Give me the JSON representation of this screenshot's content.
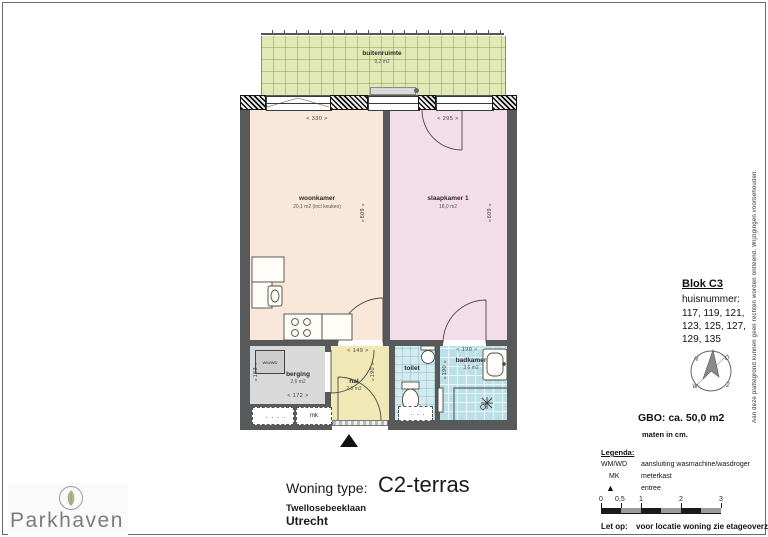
{
  "page": {
    "disclaimer": "Aan deze plattegrond kunnen geen rechten worden ontleend. Wijzigingen voorbehouden."
  },
  "plan": {
    "buitenruimte": {
      "label": "buitenruimte",
      "area": "9,2 m2"
    },
    "woonkamer": {
      "label": "woonkamer",
      "area": "20,1 m2 (incl keuken)",
      "width_dim": "<  330  >",
      "depth_dim": "609"
    },
    "slaapkamer": {
      "label": "slaapkamer 1",
      "area": "18,0 m2",
      "width_dim": "<  295  >",
      "depth_dim": "609"
    },
    "berging": {
      "label": "berging",
      "area": "2,6 m2",
      "width_dim": "<  172  >",
      "depth_dim": "153"
    },
    "hal": {
      "label": "hal",
      "area": "2,8 m2",
      "width_dim": "<  149  >",
      "depth_dim": "190"
    },
    "toilet": {
      "label": "toilet"
    },
    "badkamer": {
      "label": "badkamer",
      "area": "3,6 m2",
      "width_dim": "<  190  >",
      "depth_dim": "190"
    },
    "wm_wd_box": "WM/WD",
    "mk_box": "mk",
    "arrow_up": "∧",
    "arrow_down": "∨"
  },
  "info": {
    "blok": "Blok C3",
    "huisnummer_label": "huisnummer:",
    "huisnummers": [
      "117, 119, 121,",
      "123, 125, 127,",
      "129, 135"
    ],
    "compass": {
      "n": "N",
      "o": "O",
      "z": "Z",
      "w": "W"
    },
    "gbo": "GBO: ca. 50,0 m2",
    "maten": "maten in cm.",
    "legenda_label": "Legenda:",
    "legend": [
      {
        "key": "WM/WD",
        "value": "aansluiting wasmachine/wasdroger"
      },
      {
        "key": "MK",
        "value": "meterkast"
      },
      {
        "key": "▲",
        "value": "entree"
      }
    ],
    "scale_ticks": [
      "0",
      "0,5",
      "1",
      "2",
      "3"
    ],
    "note_label": "Let op:",
    "note": "voor locatie woning zie etageoverzicht."
  },
  "footer": {
    "type_label": "Woning type:",
    "type_value": "C2-terras",
    "street": "Twellosebeeklaan",
    "city": "Utrecht",
    "brand": "Parkhaven"
  }
}
